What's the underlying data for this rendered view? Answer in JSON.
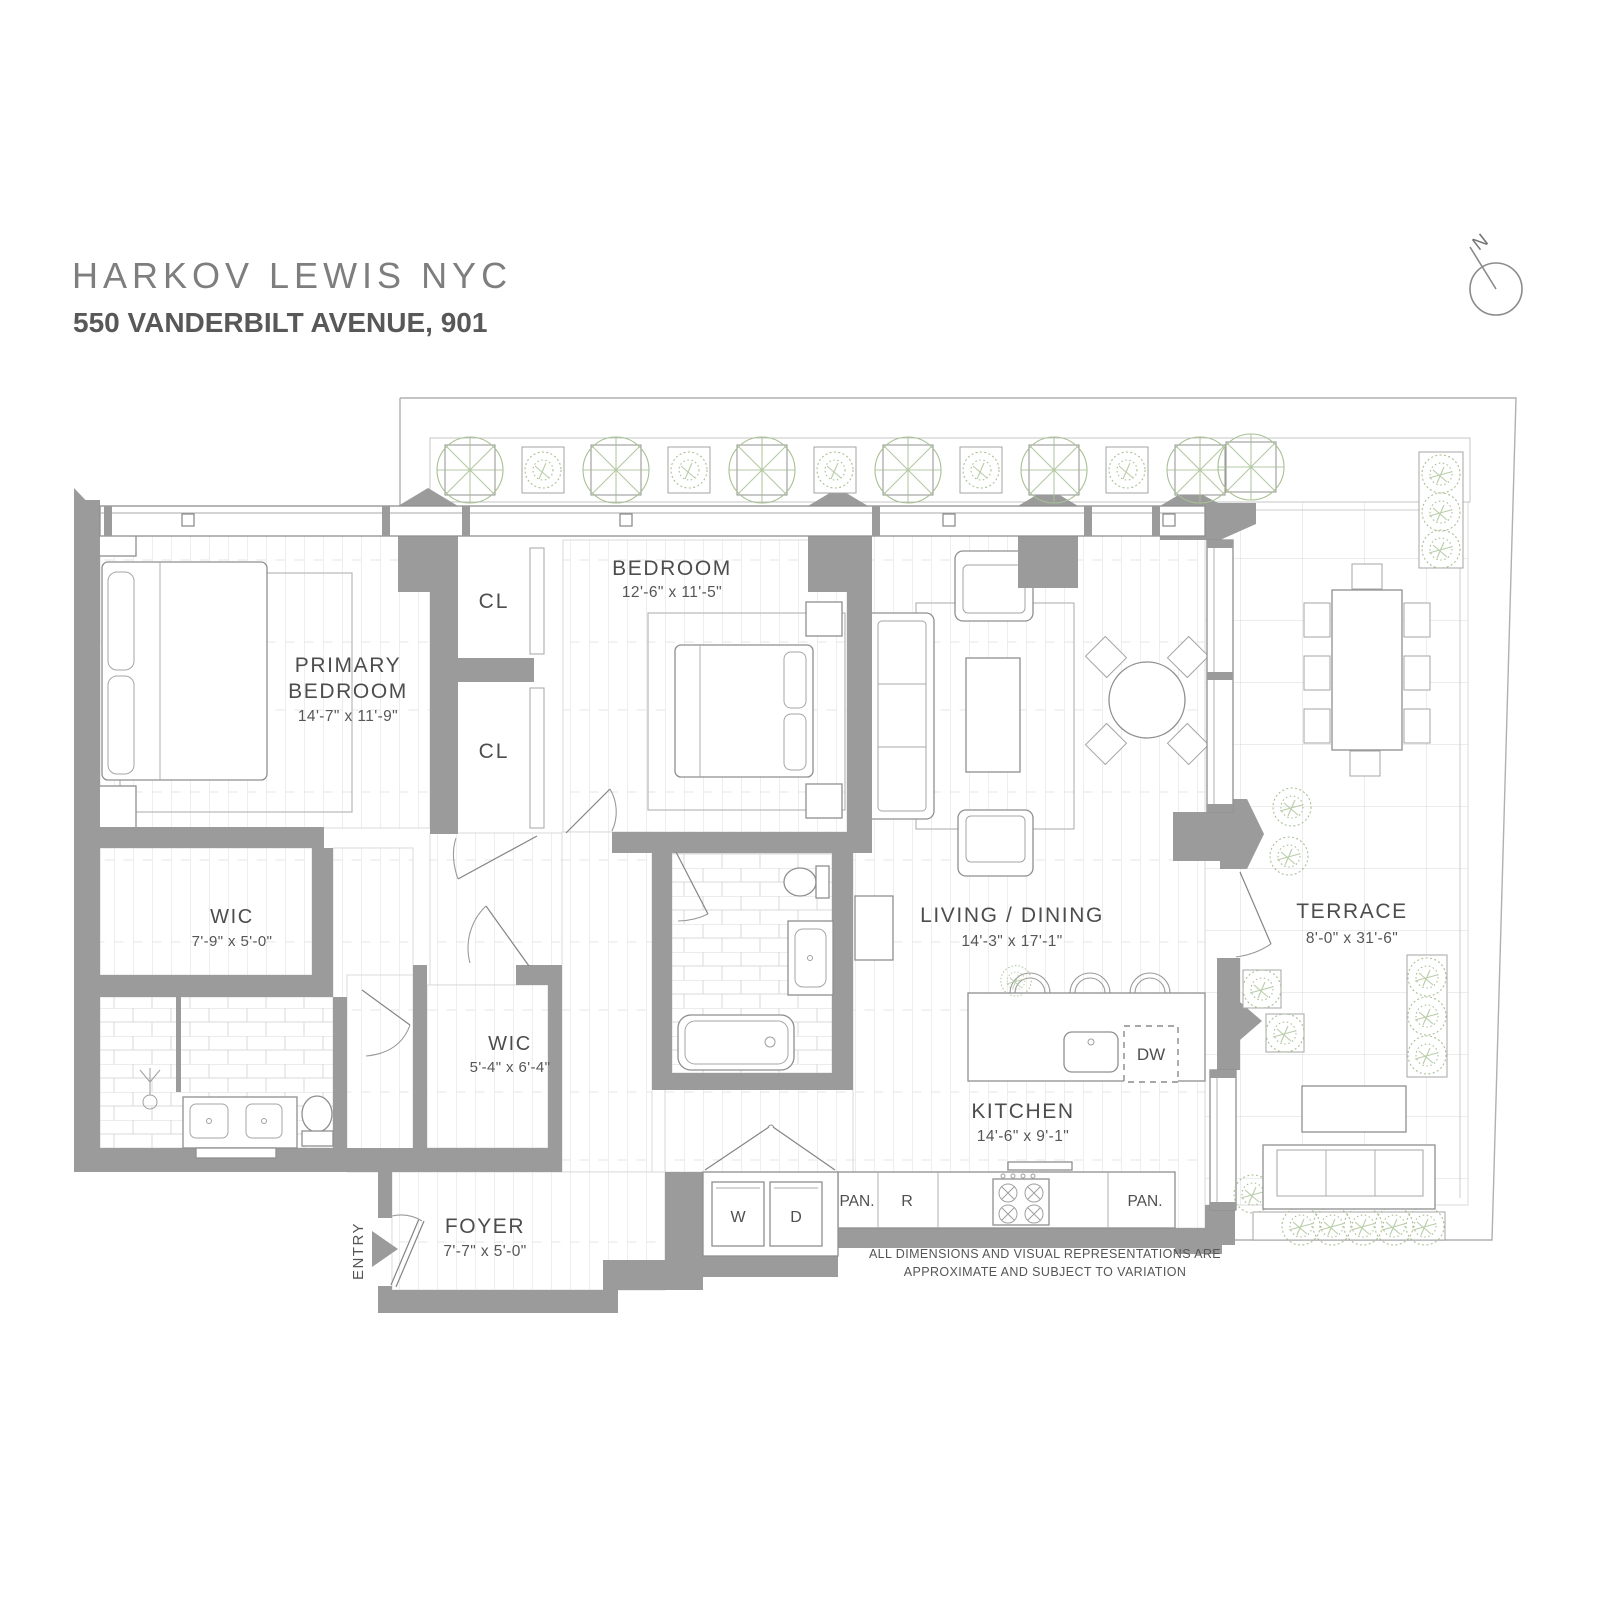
{
  "brand": {
    "title": "HARKOV LEWIS  NYC",
    "address": "550 VANDERBILT AVENUE, 901"
  },
  "compass": {
    "label": "N"
  },
  "rooms": {
    "primary_bedroom": {
      "line1": "PRIMARY",
      "line2": "BEDROOM",
      "dims": "14'-7\" x 11'-9\""
    },
    "bedroom": {
      "name": "BEDROOM",
      "dims": "12'-6\" x 11'-5\""
    },
    "living_dining": {
      "name": "LIVING / DINING",
      "dims": "14'-3\" x 17'-1\""
    },
    "kitchen": {
      "name": "KITCHEN",
      "dims": "14'-6\" x 9'-1\""
    },
    "terrace": {
      "name": "TERRACE",
      "dims": "8'-0\" x 31'-6\""
    },
    "foyer": {
      "name": "FOYER",
      "dims": "7'-7\" x 5'-0\""
    },
    "wic_primary": {
      "name": "WIC",
      "dims": "7'-9\" x 5'-0\""
    },
    "wic_hall": {
      "name": "WIC",
      "dims": "5'-4\" x 6'-4\""
    },
    "closet_1": {
      "name": "CL"
    },
    "closet_2": {
      "name": "CL"
    }
  },
  "appliances": {
    "washer": "W",
    "dryer": "D",
    "dishwasher": "DW",
    "refrigerator": "R",
    "pantry_left": "PAN.",
    "pantry_right": "PAN."
  },
  "entry_label": "ENTRY",
  "disclaimer": {
    "line1": "ALL DIMENSIONS AND VISUAL REPRESENTATIONS ARE",
    "line2": "APPROXIMATE AND SUBJECT TO VARIATION"
  },
  "colors": {
    "wall": "#9b9b9b",
    "plant": "#a8c094",
    "accent_text": "#4d4d4d"
  }
}
